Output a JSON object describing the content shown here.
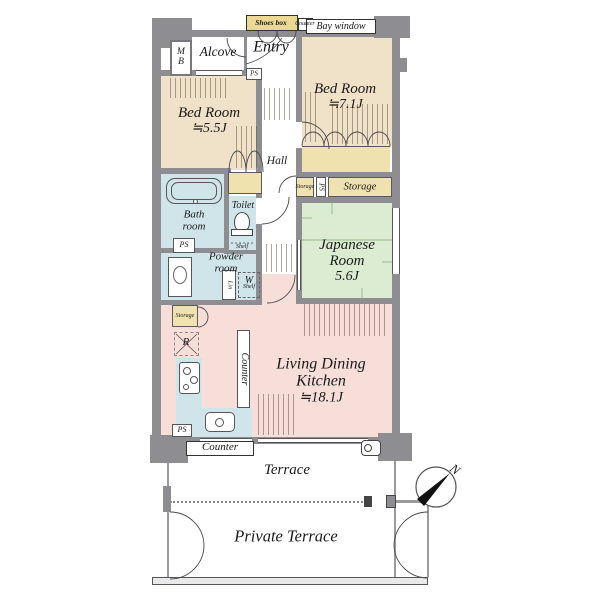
{
  "colors": {
    "wall": "#8d8d92",
    "bedroom": "#f0e1c9",
    "closet": "#f0e2ae",
    "shoes": "#ead893",
    "japanese": "#dcecd3",
    "ldk": "#f7ded8",
    "water": "#cfe5ea",
    "tatami_line": "#98bb90",
    "arrow_black": "#111111"
  },
  "rooms": {
    "bedroom_a": {
      "name": "Bed Room",
      "size": "≒5.5J"
    },
    "bedroom_b": {
      "name": "Bed Room",
      "size": "≒7.1J"
    },
    "japanese": {
      "line1": "Japanese",
      "line2": "Room",
      "size": "5.6J"
    },
    "ldk": {
      "line1": "Living Dining",
      "line2": "Kitchen",
      "size": "≒18.1J"
    }
  },
  "labels": {
    "alcove": "Alcove",
    "entry": "Entry",
    "shoes_box": "Shoes box",
    "bay_window": "Bay window",
    "mb_m": "M",
    "mb_b": "B",
    "hall": "Hall",
    "ps": "PS",
    "storage": "Storage",
    "toilet": "Toilet",
    "shelf": "Shelf",
    "bath_1": "Bath",
    "bath_2": "room",
    "powder_1": "Powder",
    "powder_2": "room",
    "lin": "Lin",
    "w": "W",
    "r": "R",
    "counter": "Counter",
    "terrace": "Terrace",
    "private_terrace": "Private Terrace",
    "north": "N"
  }
}
